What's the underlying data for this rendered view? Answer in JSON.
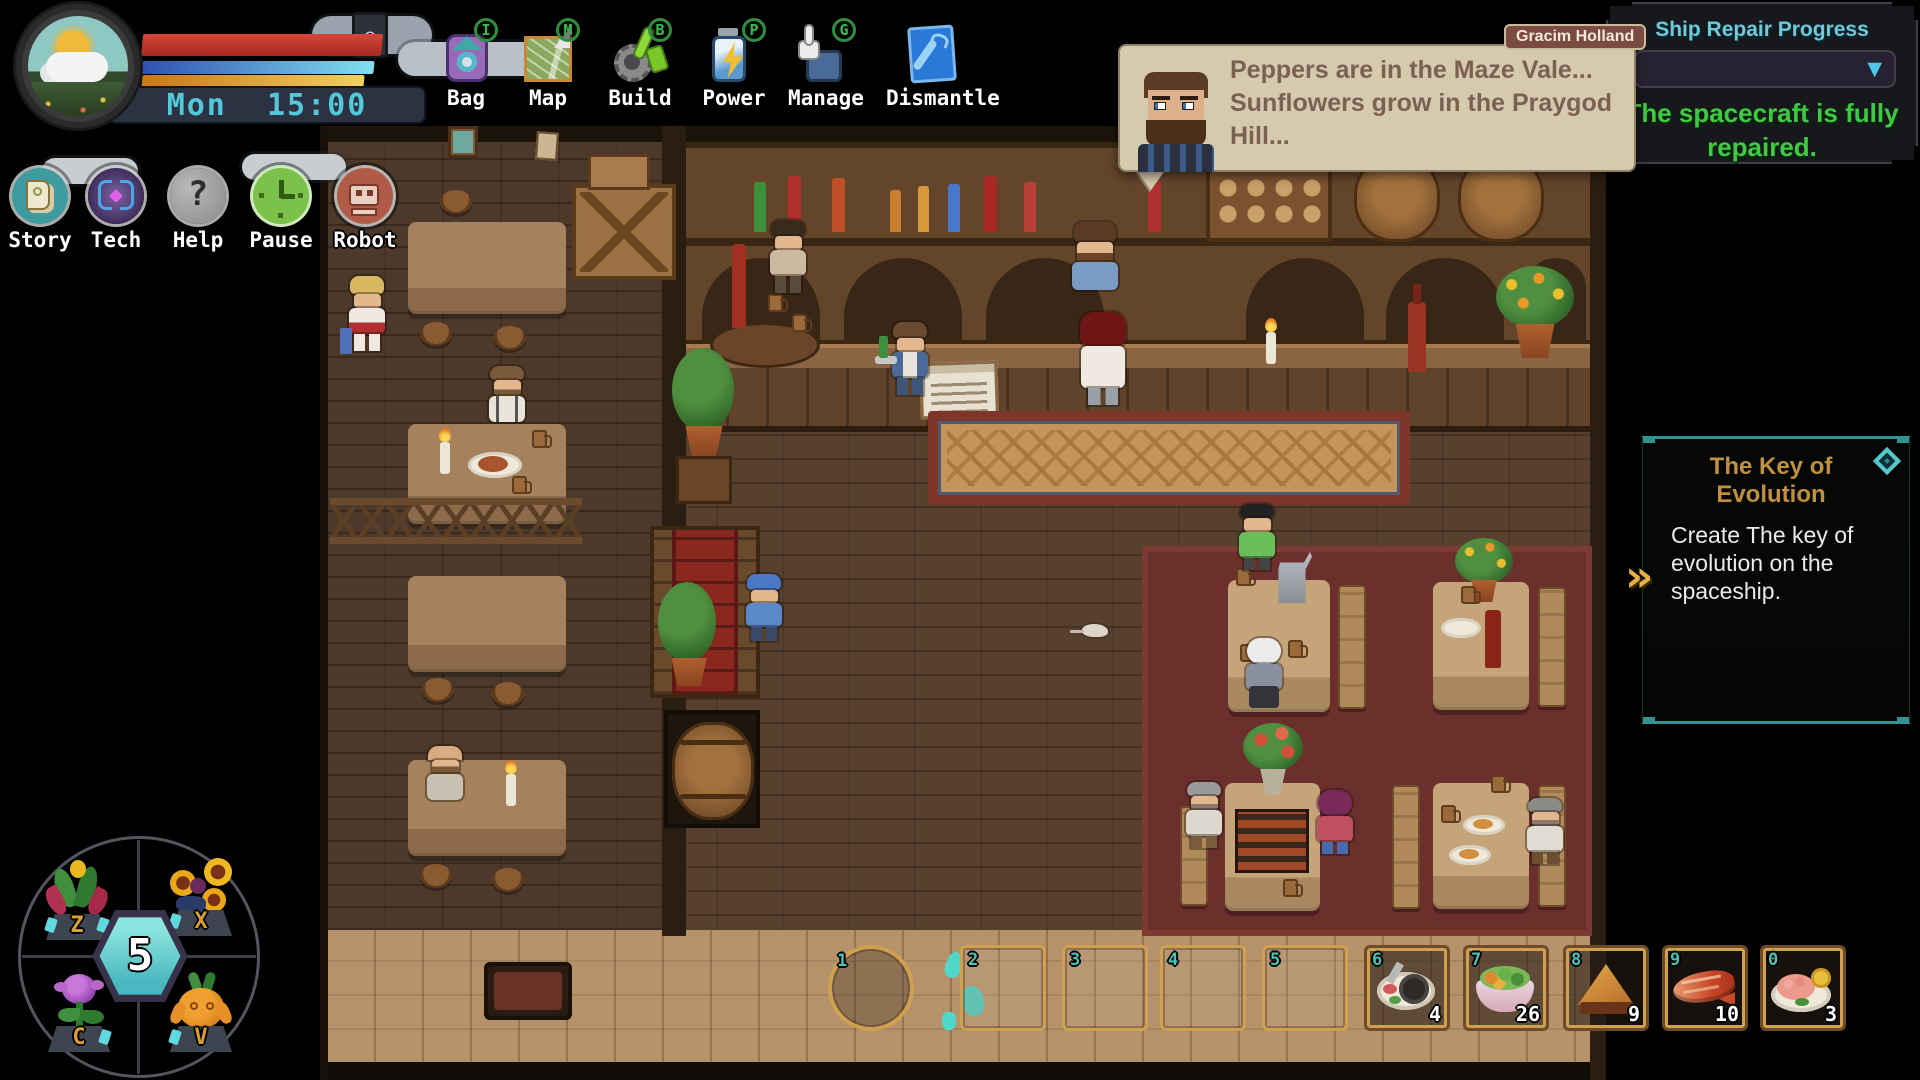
{
  "hud": {
    "day": "Mon",
    "time": "15:00",
    "weather_icon": "sun-behind-cloud",
    "bars": {
      "health": "#c23830",
      "water": "#6ecbe8",
      "energy": "#e8b545"
    }
  },
  "toolbar": [
    {
      "label": "Bag",
      "hotkey": "I"
    },
    {
      "label": "Map",
      "hotkey": "M"
    },
    {
      "label": "Build",
      "hotkey": "B"
    },
    {
      "label": "Power",
      "hotkey": "P"
    },
    {
      "label": "Manage",
      "hotkey": "G"
    },
    {
      "label": "Dismantle",
      "hotkey": ""
    }
  ],
  "menu_buttons": [
    {
      "label": "Story"
    },
    {
      "label": "Tech"
    },
    {
      "label": "Help"
    },
    {
      "label": "Pause"
    },
    {
      "label": "Robot"
    }
  ],
  "dialogue": {
    "speaker": "Gracim Holland",
    "line1": "Peppers are in the Maze Vale...",
    "line2": "Sunflowers grow in the Praygod Hill..."
  },
  "ship_repair": {
    "title": "Ship Repair Progress",
    "status": "The spacecraft is fully repaired."
  },
  "quest": {
    "title": "The Key of Evolution",
    "description": "Create The key of evolution on the spaceship."
  },
  "hotbar": {
    "slots": [
      {
        "key": "1",
        "item": "",
        "count": ""
      },
      {
        "key": "2",
        "item": "",
        "count": ""
      },
      {
        "key": "3",
        "item": "",
        "count": ""
      },
      {
        "key": "4",
        "item": "",
        "count": ""
      },
      {
        "key": "5",
        "item": "",
        "count": ""
      },
      {
        "key": "6",
        "item": "hotpot-plate",
        "count": "4"
      },
      {
        "key": "7",
        "item": "veggie-bowl",
        "count": "26"
      },
      {
        "key": "8",
        "item": "pie-slice",
        "count": "9"
      },
      {
        "key": "9",
        "item": "grilled-fish",
        "count": "10"
      },
      {
        "key": "0",
        "item": "shrimp-plate",
        "count": "3"
      }
    ]
  },
  "pet_wheel": {
    "center": "5",
    "slots": [
      {
        "key": "Z",
        "pet": "corn-plant"
      },
      {
        "key": "X",
        "pet": "sunflower-cluster"
      },
      {
        "key": "C",
        "pet": "purple-rose"
      },
      {
        "key": "V",
        "pet": "carrot-sprout"
      }
    ]
  }
}
